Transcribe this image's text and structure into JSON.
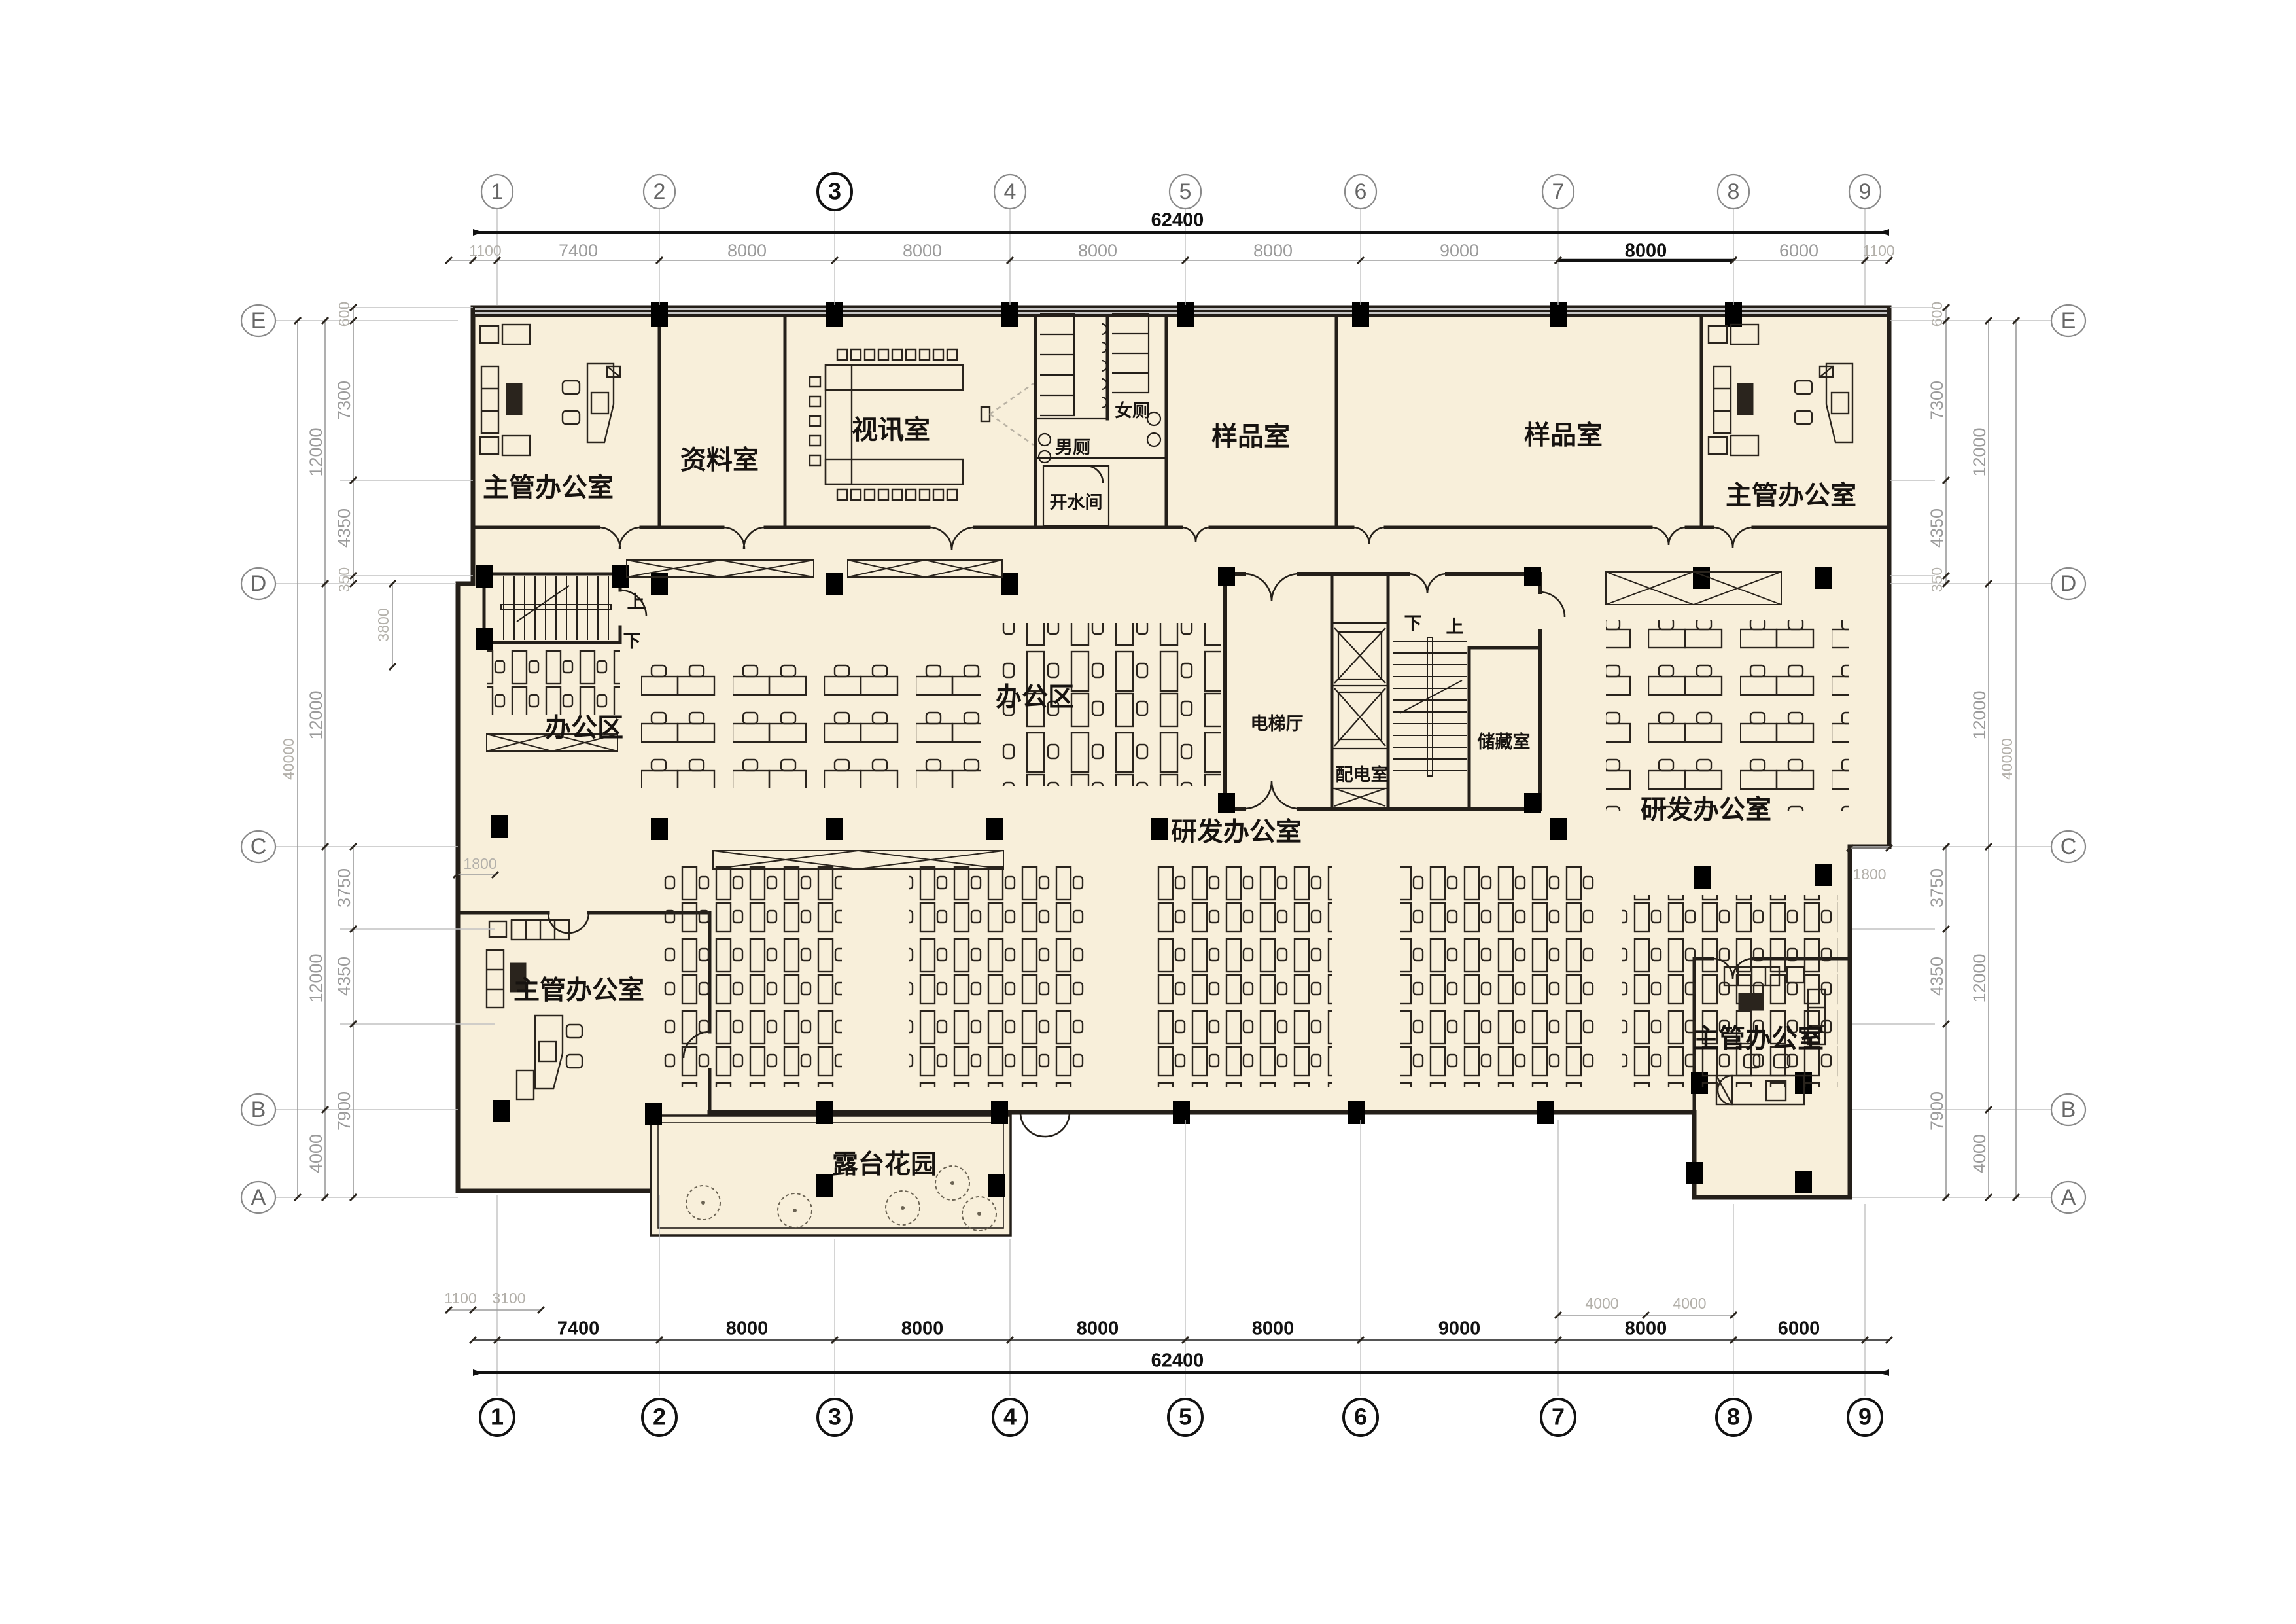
{
  "title": "二层平面图",
  "colors": {
    "floor": "#f8efda",
    "wall": "#241f19",
    "dim_text": "#9b9b9b",
    "ink": "#111111"
  },
  "grid": {
    "cols": [
      "1",
      "2",
      "3",
      "4",
      "5",
      "6",
      "7",
      "8",
      "9"
    ],
    "rows": [
      "E",
      "D",
      "C",
      "B",
      "A"
    ]
  },
  "dims": {
    "top": {
      "pre": "1100",
      "segs": [
        "7400",
        "8000",
        "8000",
        "8000",
        "8000",
        "9000",
        "8000",
        "6000"
      ],
      "post": "1100",
      "total": "62400"
    },
    "bottom": {
      "segs": [
        "7400",
        "8000",
        "8000",
        "8000",
        "8000",
        "9000",
        "8000",
        "6000"
      ],
      "total": "62400",
      "sub_left": [
        "1100",
        "3100"
      ],
      "sub_right": [
        "4000",
        "4000"
      ]
    },
    "left": {
      "total": "40000",
      "mid": [
        "12000",
        "12000",
        "12000",
        "4000"
      ],
      "upper": [
        "600",
        "7300",
        "4350",
        "350"
      ],
      "stair": "3800",
      "lower": [
        "3750",
        "4350",
        "7900"
      ],
      "notch": "1800"
    },
    "right": {
      "total": "40000",
      "mid": [
        "12000",
        "12000",
        "12000",
        "4000"
      ],
      "upper": [
        "600",
        "7300",
        "4350",
        "350"
      ],
      "lower": [
        "3750",
        "4350",
        "7900"
      ],
      "notch": "1800"
    }
  },
  "rooms": {
    "exec_office": "主管办公室",
    "archive": "资料室",
    "video": "视讯室",
    "men_toilet": "男厕",
    "women_toilet": "女厕",
    "water_room": "开水间",
    "sample_room": "样品室",
    "office_area": "办公区",
    "elevator_hall": "电梯厅",
    "power_room": "配电室",
    "storage": "储藏室",
    "rnd_office": "研发办公室",
    "terrace": "露台花园"
  },
  "stair": {
    "up": "上",
    "down": "下"
  }
}
